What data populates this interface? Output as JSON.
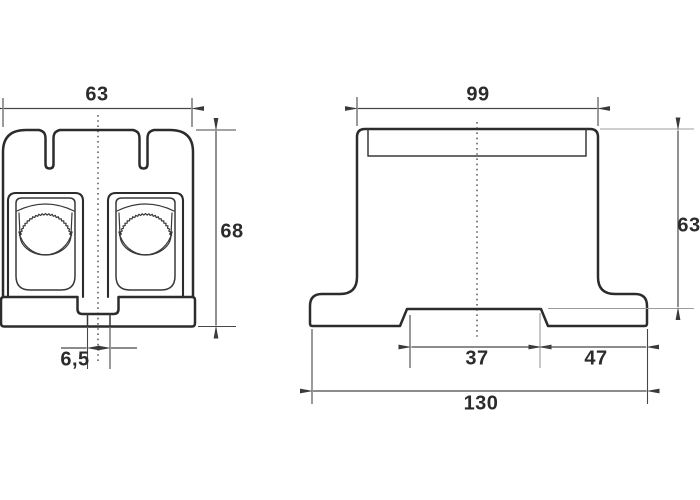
{
  "dimensions": {
    "front_view": {
      "width": "63",
      "height": "68",
      "slot_width": "6,5"
    },
    "side_view": {
      "top_width": "99",
      "height": "63",
      "recess_width": "37",
      "right_section": "47",
      "base_width": "130"
    }
  },
  "colors": {
    "outline": "#2c2c2c",
    "dimension": "#474747",
    "light_extension": "#9c9c9c",
    "background": "#ffffff"
  }
}
